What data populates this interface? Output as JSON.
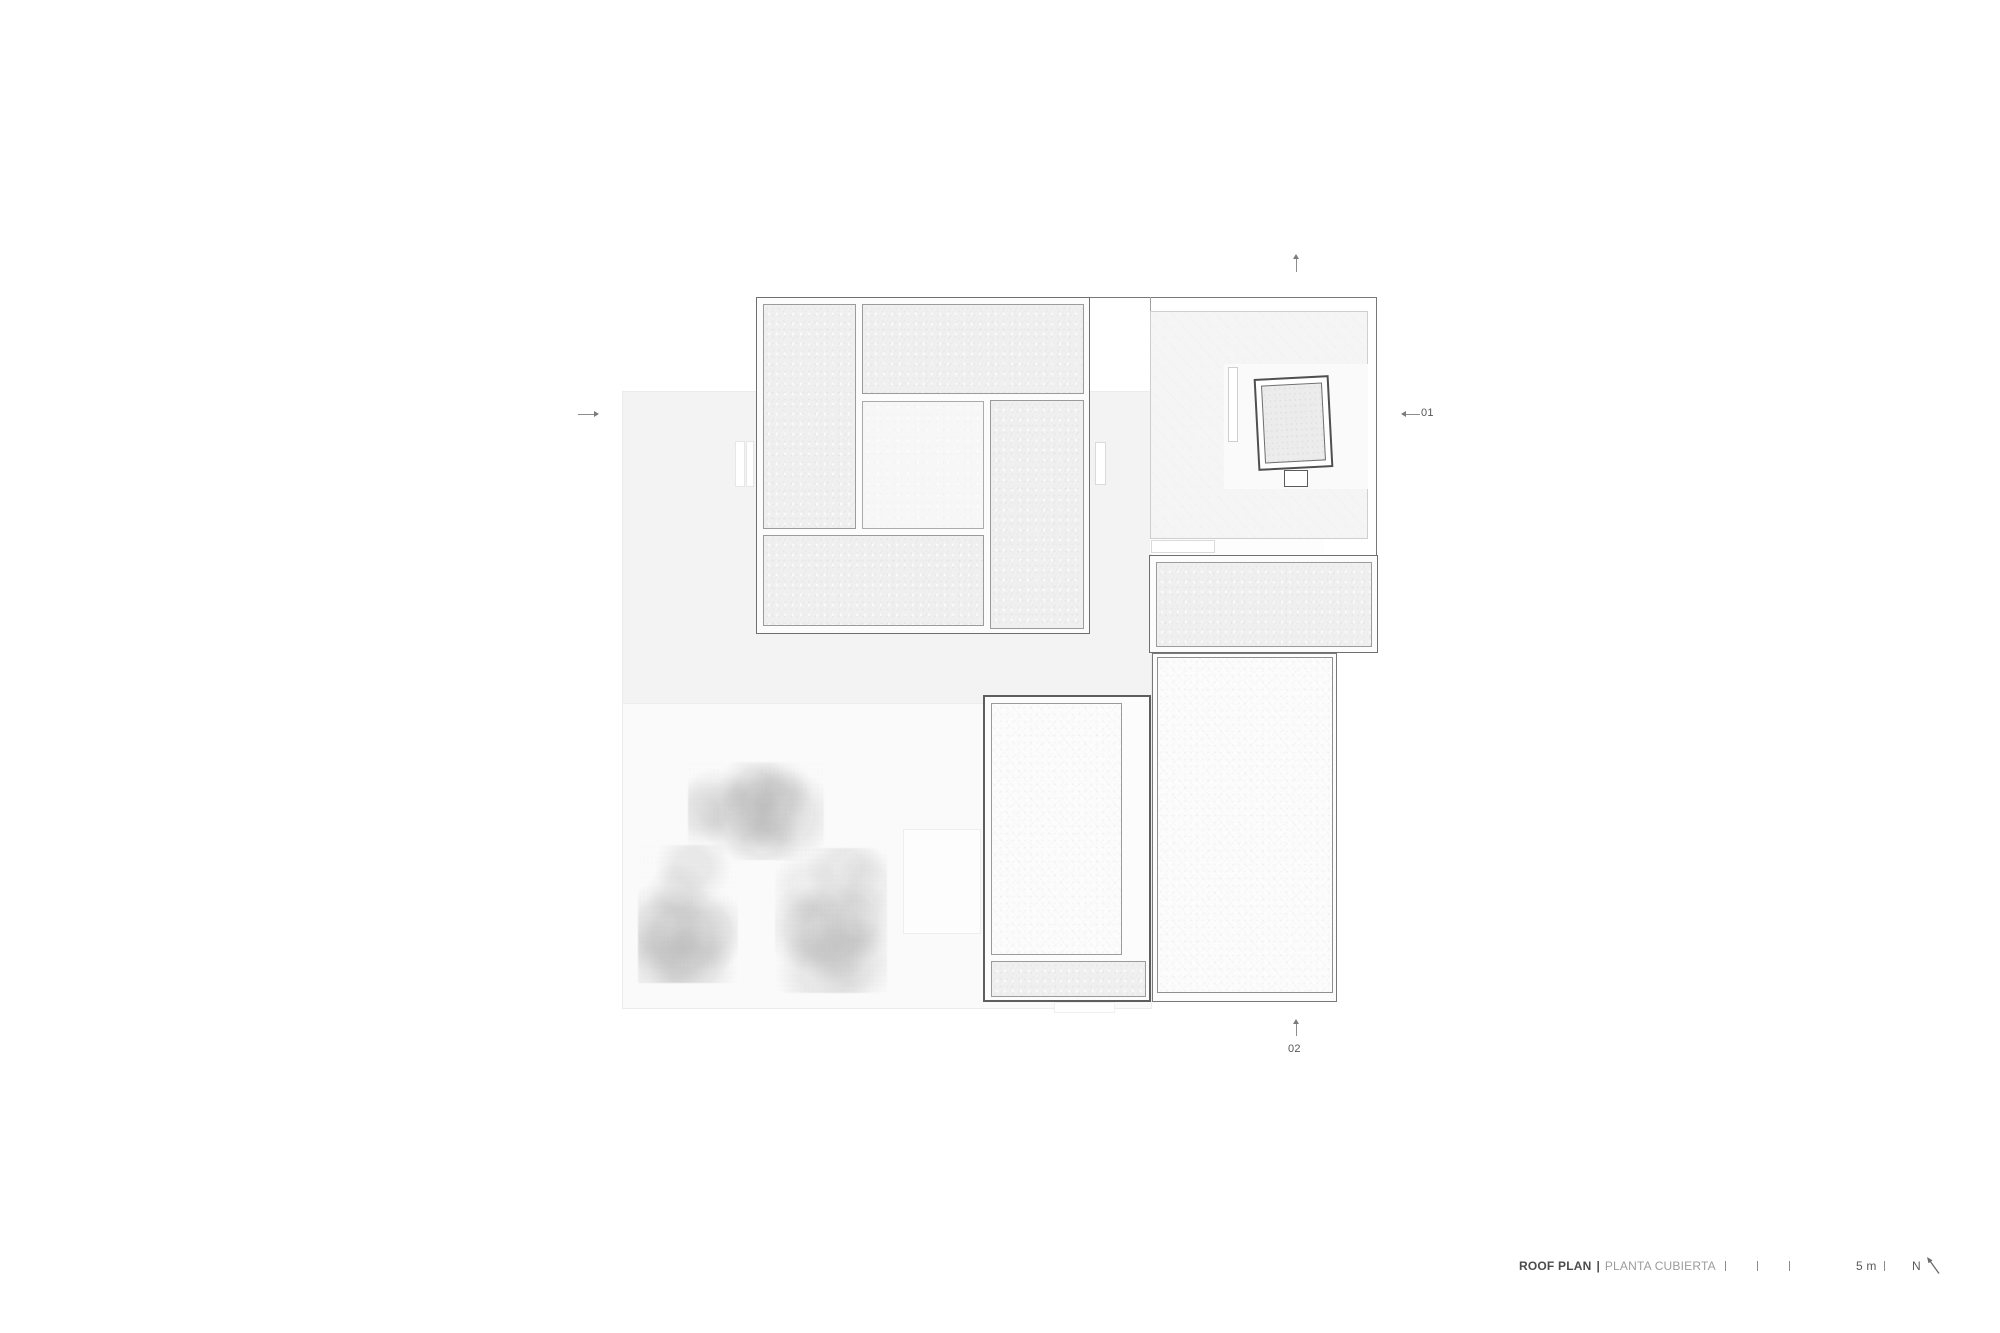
{
  "drawing": {
    "title": "ROOF PLAN",
    "separator": "|",
    "subtitle": "PLANTA CUBIERTA",
    "scale_label": "5 m",
    "north_label": "N"
  },
  "section_markers": {
    "right_label": "01",
    "bottom_label": "02"
  },
  "colors": {
    "paper": "#ffffff",
    "terrace": "#f3f3f3",
    "garden": "#fafafa",
    "roof_panel": "#f0f0f0",
    "roof_white": "#fdfdfd",
    "outline_dark": "#6f6f6f",
    "outline_light": "#9b9b9b",
    "title_text": "#4c4c4c",
    "subtitle_text": "#9c9c9c",
    "marker_text": "#565656"
  }
}
